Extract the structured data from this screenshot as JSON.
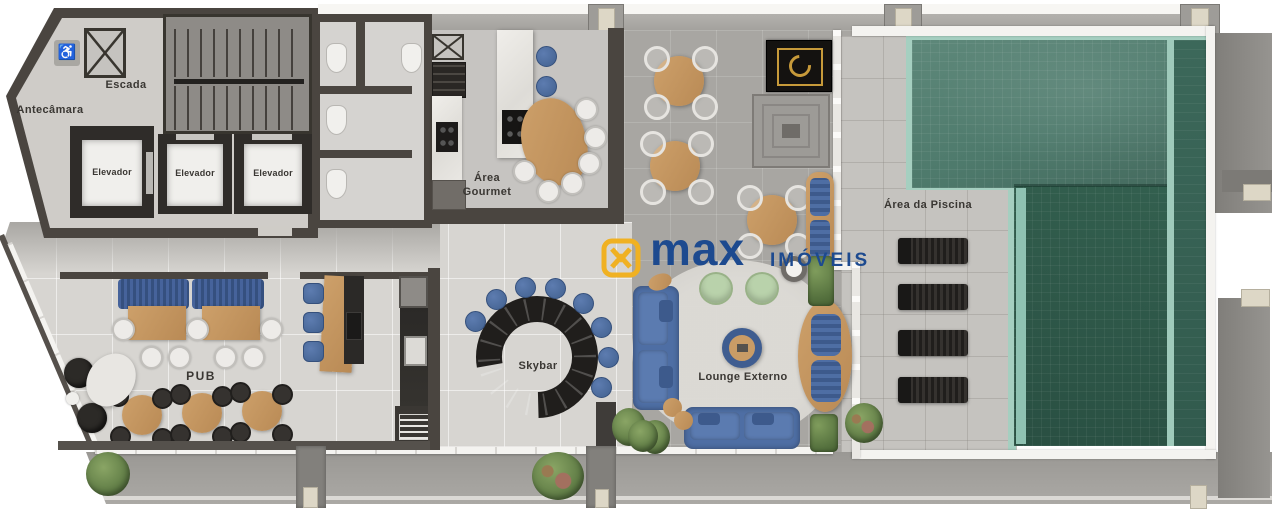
{
  "meta": {
    "kind": "residential amenities floor plan",
    "language": "pt-BR"
  },
  "brand": {
    "name": "max",
    "suffix": "IMÓVEIS",
    "colors": {
      "yellow": "#F0B122",
      "blue": "#1D4A8F"
    }
  },
  "icons": {
    "accessibility": "♿"
  },
  "rooms": {
    "antecamara": {
      "label": "Antecâmara"
    },
    "escada": {
      "label": "Escada"
    },
    "elevador_1": {
      "label": "Elevador"
    },
    "elevador_2": {
      "label": "Elevador"
    },
    "elevador_3": {
      "label": "Elevador"
    },
    "area_gourmet": {
      "label": "Área Gourmet"
    },
    "pub": {
      "label": "PUB"
    },
    "skybar": {
      "label": "Skybar"
    },
    "lounge_externo": {
      "label": "Lounge Externo"
    },
    "area_da_piscina": {
      "label": "Área da Piscina"
    }
  }
}
